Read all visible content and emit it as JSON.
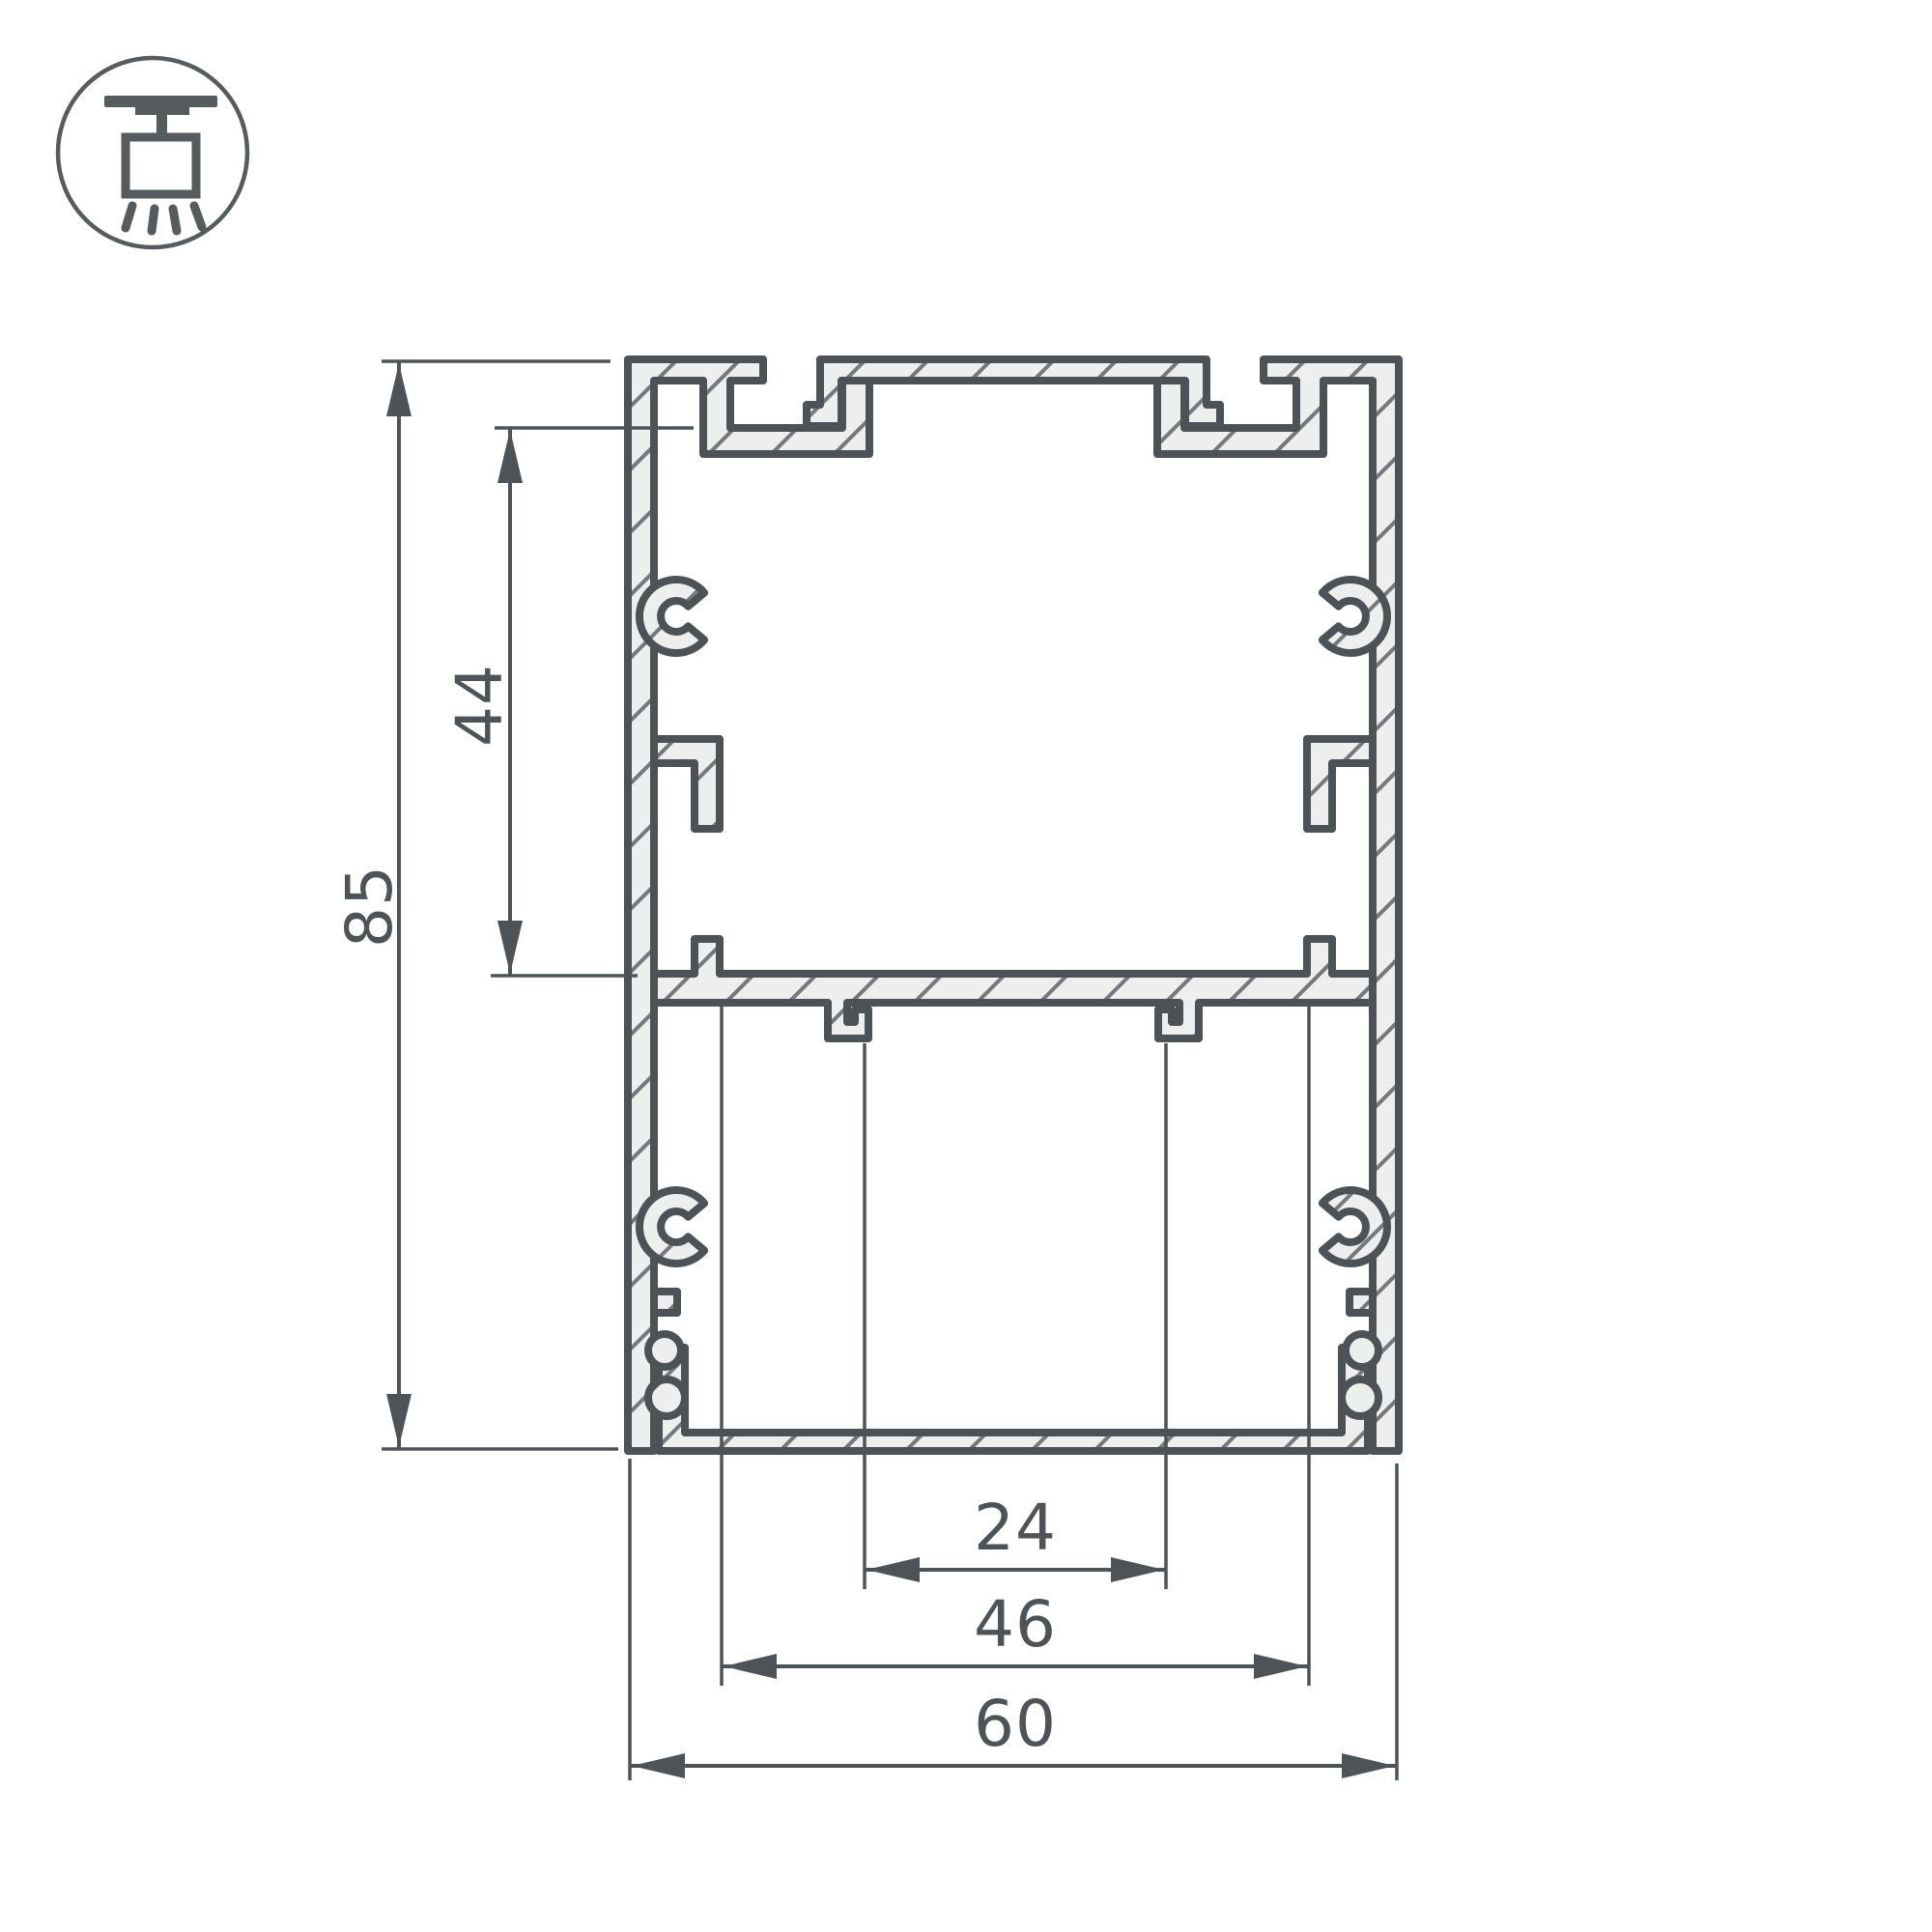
{
  "page": {
    "background": "#ffffff"
  },
  "icon": {
    "name": "pendant-ceiling-mount-icon"
  },
  "drawing": {
    "type": "aluminum-profile-cross-section",
    "labels": {
      "overall_height": "85",
      "cavity_height": "44",
      "slot_width": "24",
      "inner_width": "46",
      "overall_width": "60"
    },
    "colors": {
      "line": "#4d5357",
      "outline": "#4c5255",
      "metal_fill": "#edeeee",
      "hatch_line": "#75797b",
      "background": "#ffffff"
    }
  }
}
